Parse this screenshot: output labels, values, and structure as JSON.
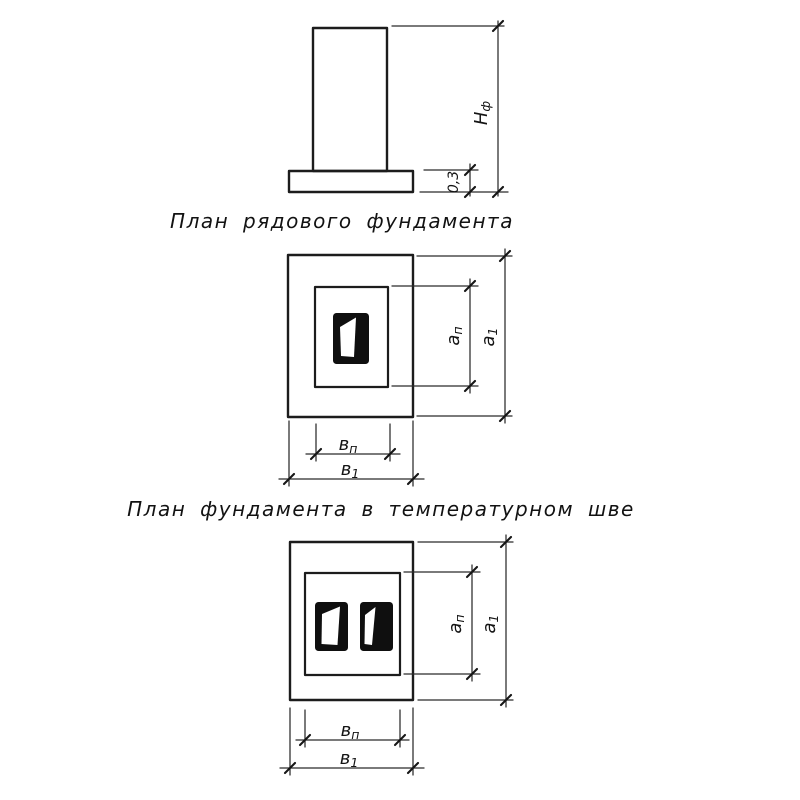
{
  "figure": {
    "elevation": {
      "dim_foundation_height": {
        "base": "Н",
        "sub": "ф"
      },
      "dim_footing_thickness": "0,3"
    },
    "plan_single": {
      "caption": "План рядового фундамента",
      "dim_a_inner": {
        "base": "а",
        "sub": "п"
      },
      "dim_a_outer": {
        "base": "а",
        "sub": "1"
      },
      "dim_b_inner": {
        "base": "в",
        "sub": "п"
      },
      "dim_b_outer": {
        "base": "в",
        "sub": "1"
      }
    },
    "plan_double": {
      "caption": "План фундамента в температурном шве",
      "dim_a_inner": {
        "base": "а",
        "sub": "п"
      },
      "dim_a_outer": {
        "base": "а",
        "sub": "1"
      },
      "dim_b_inner": {
        "base": "в",
        "sub": "п"
      },
      "dim_b_outer": {
        "base": "в",
        "sub": "1"
      }
    }
  }
}
